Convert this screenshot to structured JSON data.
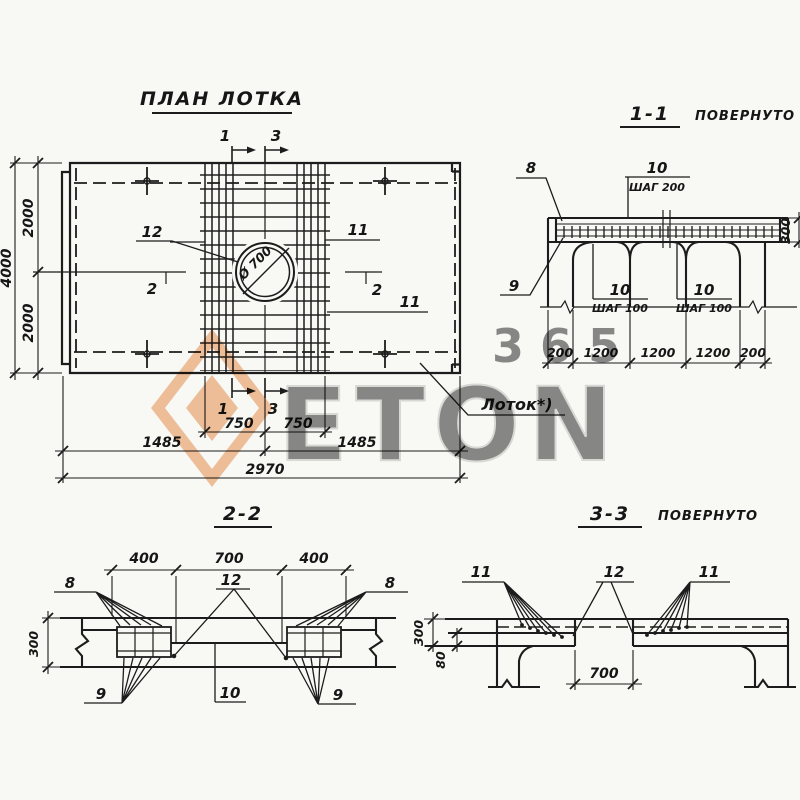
{
  "drawing": {
    "plan": {
      "title": "ПЛАН ЛОТКА",
      "hole_label": "Ø 700",
      "lotok_label": "Лоток*)",
      "callout_12": "12",
      "callout_11_top": "11",
      "callout_11_bot": "11",
      "mark_1_top": "1",
      "mark_3_top": "3",
      "mark_1_bot": "1",
      "mark_3_bot": "3",
      "mark_2_left": "2",
      "mark_2_right": "2",
      "dim_4000": "4000",
      "dim_2000_top": "2000",
      "dim_2000_bot": "2000",
      "dim_750_l": "750",
      "dim_750_r": "750",
      "dim_1485_l": "1485",
      "dim_1485_r": "1485",
      "dim_2970": "2970"
    },
    "sec11": {
      "title": "1-1",
      "rotated": "ПОВЕРНУТО",
      "callout_8": "8",
      "callout_9": "9",
      "step200_num": "10",
      "step200_txt": "ШАГ 200",
      "step100a_num": "10",
      "step100a_txt": "ШАГ 100",
      "step100b_num": "10",
      "step100b_txt": "ШАГ 100",
      "dim_300": "300",
      "dim_200_l": "200",
      "dim_1200_a": "1200",
      "dim_1200_b": "1200",
      "dim_1200_c": "1200",
      "dim_200_r": "200"
    },
    "sec22": {
      "title": "2-2",
      "dim_400_l": "400",
      "dim_700": "700",
      "dim_400_r": "400",
      "dim_300": "300",
      "callout_8_l": "8",
      "callout_8_r": "8",
      "callout_12": "12",
      "callout_9_l": "9",
      "callout_9_r": "9",
      "callout_10": "10"
    },
    "sec33": {
      "title": "3-3",
      "rotated": "ПОВЕРНУТО",
      "callout_11_l": "11",
      "callout_12": "12",
      "callout_11_r": "11",
      "dim_300": "300",
      "dim_80": "80",
      "dim_700": "700"
    },
    "watermark": {
      "digits": "365",
      "letters": "ETON",
      "orange": "#e8873c",
      "gray": "#d2d2d2"
    }
  }
}
